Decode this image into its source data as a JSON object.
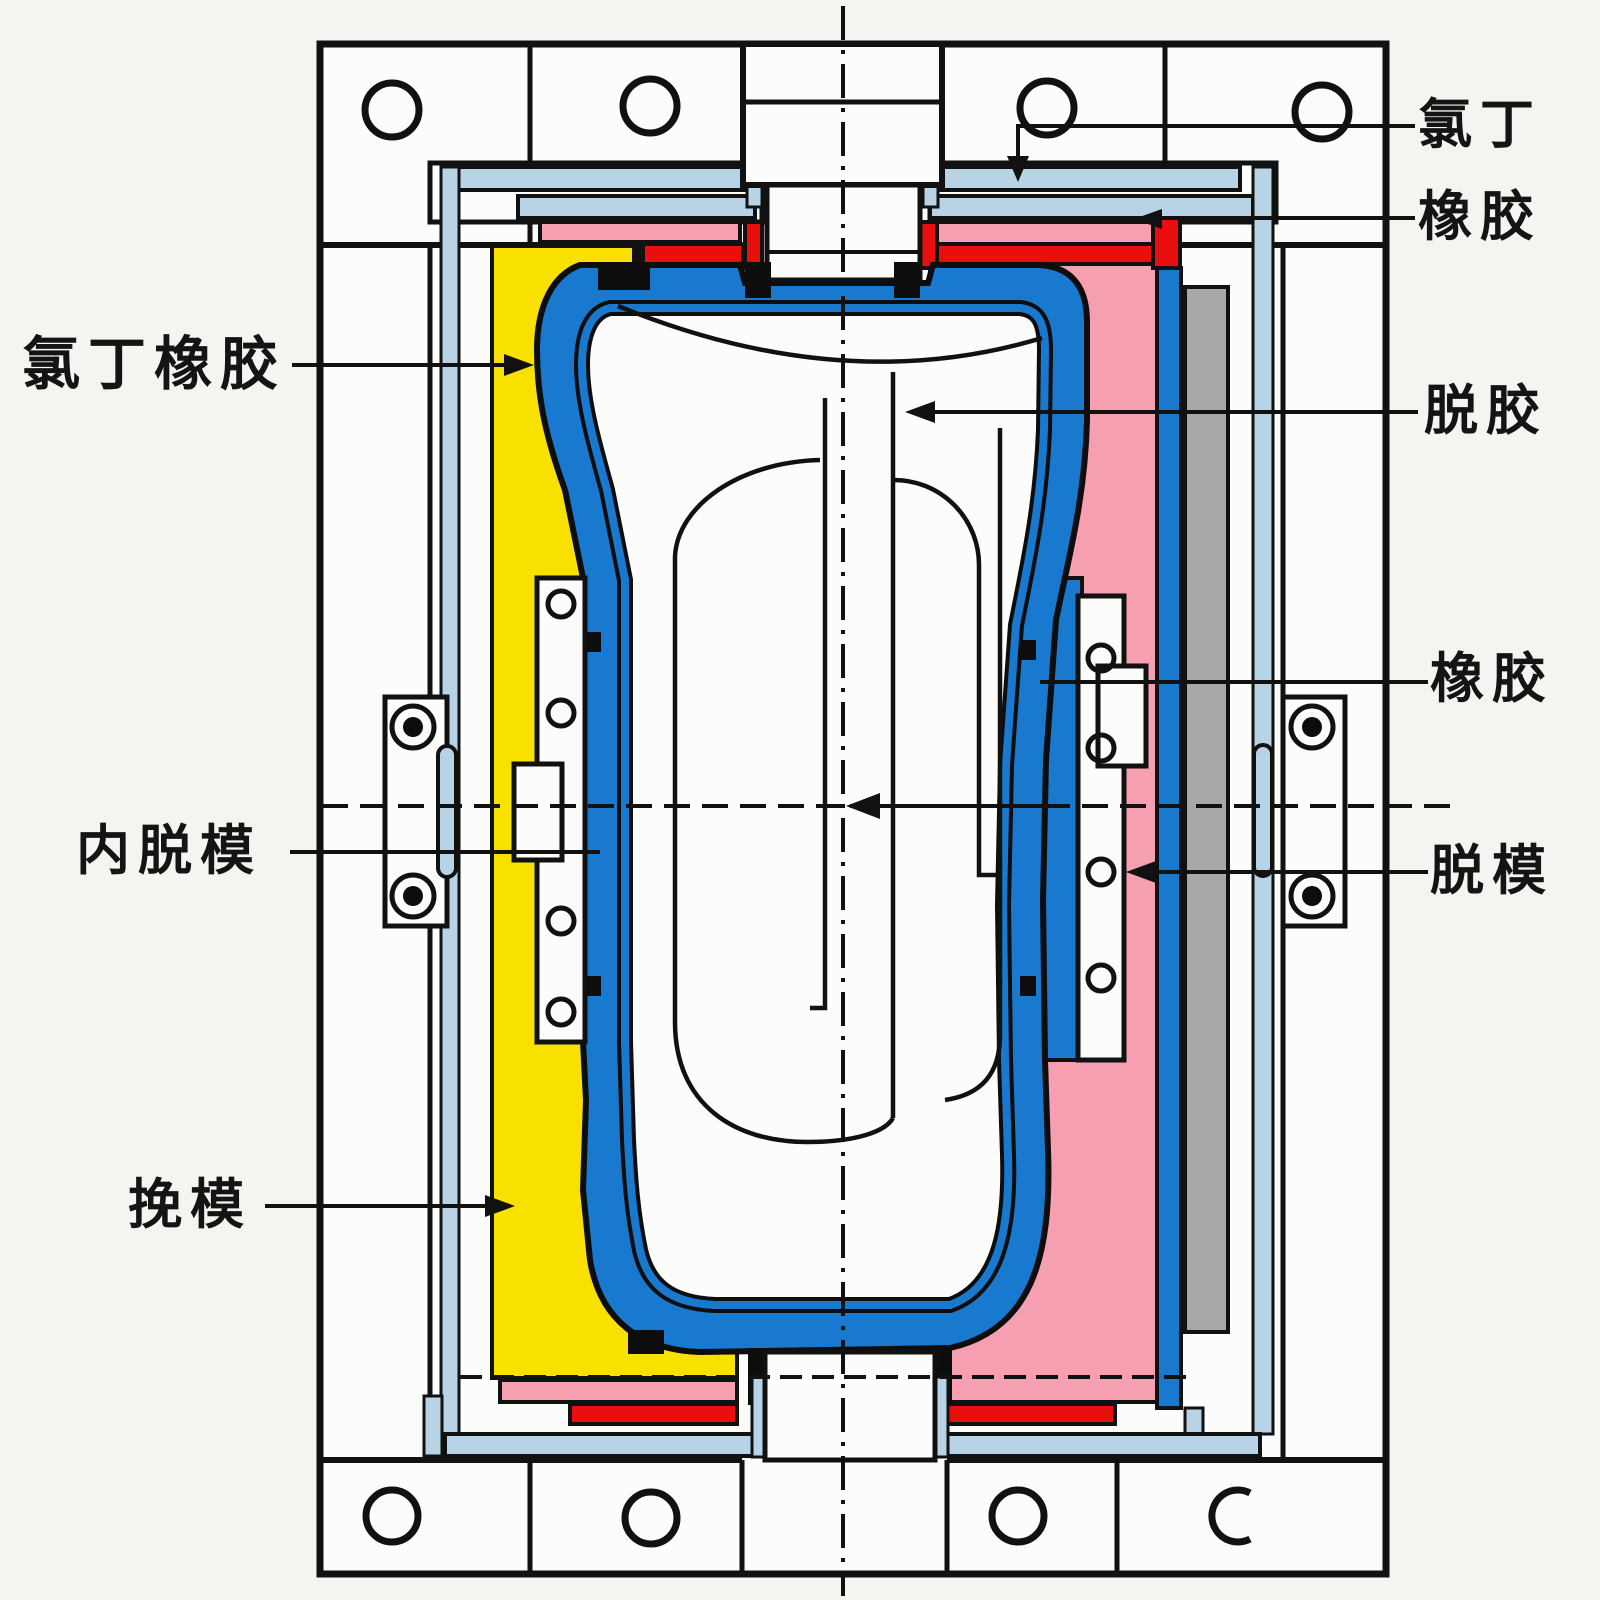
{
  "diagram": {
    "type": "engineering-cross-section",
    "subject": "rubber mold assembly cross-section",
    "labels": [
      {
        "id": "chloroprene",
        "text": "氯丁",
        "side": "top-right"
      },
      {
        "id": "rubber_top",
        "text": "橡胶",
        "side": "top-right"
      },
      {
        "id": "chloroprene_rubber",
        "text": "氯丁橡胶",
        "side": "left"
      },
      {
        "id": "degumming",
        "text": "脱胶",
        "side": "right"
      },
      {
        "id": "rubber_mid",
        "text": "橡胶",
        "side": "right"
      },
      {
        "id": "inner_demold",
        "text": "内脱模",
        "side": "left"
      },
      {
        "id": "demold",
        "text": "脱模",
        "side": "right"
      },
      {
        "id": "wan_mold",
        "text": "挽模",
        "side": "bottom-left"
      }
    ],
    "colors": {
      "blue": "#1879cf",
      "light_blue": "#b8d3e6",
      "yellow": "#f8e000",
      "pink": "#f59fb0",
      "red": "#e90f0f",
      "gray": "#a8a8a8",
      "line": "#111111",
      "paper": "#f6f4f0",
      "white": "#fcfcfa"
    }
  }
}
